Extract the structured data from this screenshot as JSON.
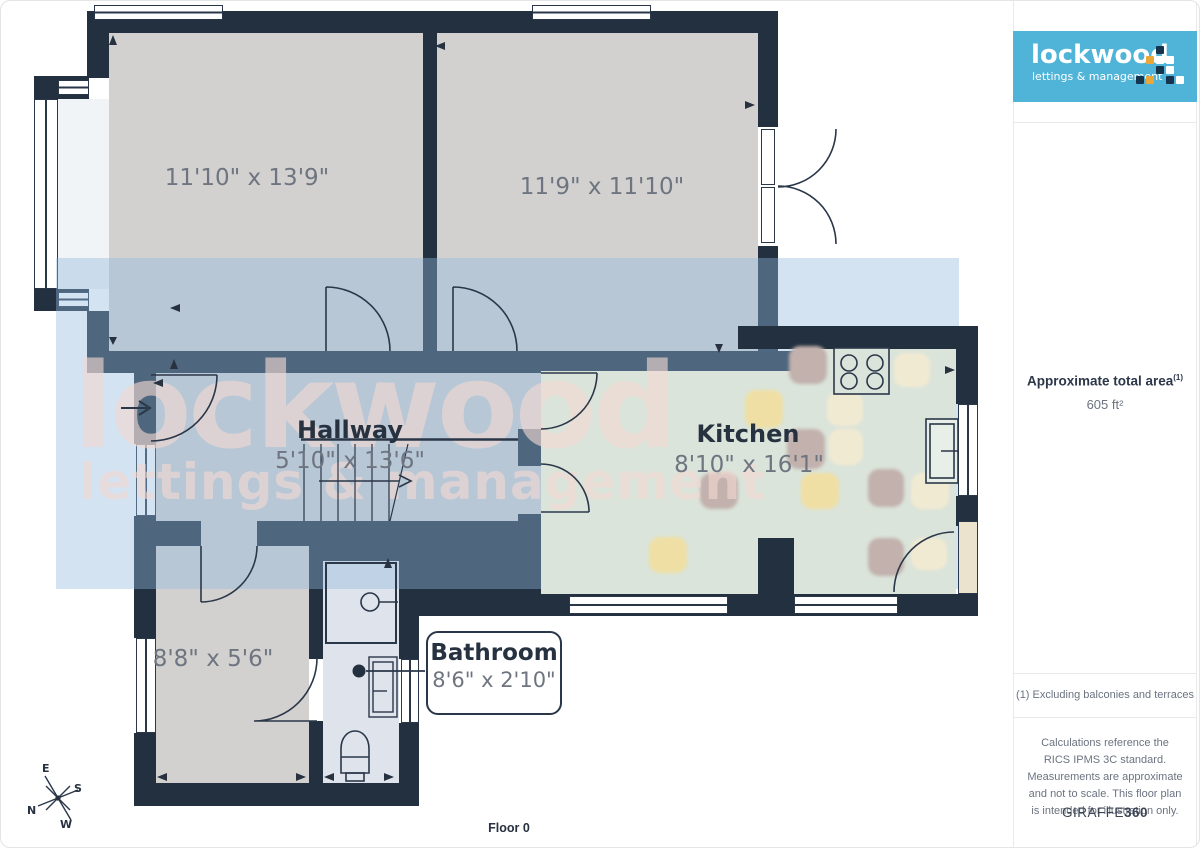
{
  "plan": {
    "rooms": [
      {
        "name": "",
        "dims": "11'10\" x 13'9\""
      },
      {
        "name": "",
        "dims": "11'9\" x 11'10\""
      },
      {
        "name": "Hallway",
        "dims": "5'10\" x 13'6\""
      },
      {
        "name": "Kitchen",
        "dims": "8'10\" x 16'1\""
      },
      {
        "name": "",
        "dims": "8'8\" x 5'6\""
      }
    ],
    "callout": {
      "name": "Bathroom",
      "dims": "8'6\" x 2'10\""
    },
    "floor_label": "Floor 0",
    "compass": {
      "n": "N",
      "e": "E",
      "s": "S",
      "w": "W"
    },
    "watermark": {
      "line1": "lockwood",
      "line2": "lettings & management"
    }
  },
  "sidebar": {
    "logo": {
      "line1": "lockwood",
      "line2": "lettings & management"
    },
    "area": {
      "label": "Approximate total area",
      "sup": "(1)",
      "value": "605 ft²"
    },
    "footnote": "(1) Excluding balconies and terraces",
    "disclaimer": "Calculations reference the RICS IPMS 3C standard. Measurements are approximate and not to scale. This floor plan is intended for illustration only.",
    "brand": {
      "name": "GIRAFFE",
      "suffix": "360"
    }
  },
  "colors": {
    "wall": "#22303f",
    "floor_gray": "#d2d1cf",
    "kitchen_floor": "#dbe4da",
    "bathroom_floor": "#dfe3ec",
    "watermark_band": "#92b9df",
    "watermark_text": "#f3d9d2",
    "logo_blue": "#50b4d8",
    "logo_gold": "#e9a63a",
    "tile_cream": "#f1ead2",
    "tile_yellow": "#efdfa4",
    "tile_mauve": "#c2b1ad"
  }
}
